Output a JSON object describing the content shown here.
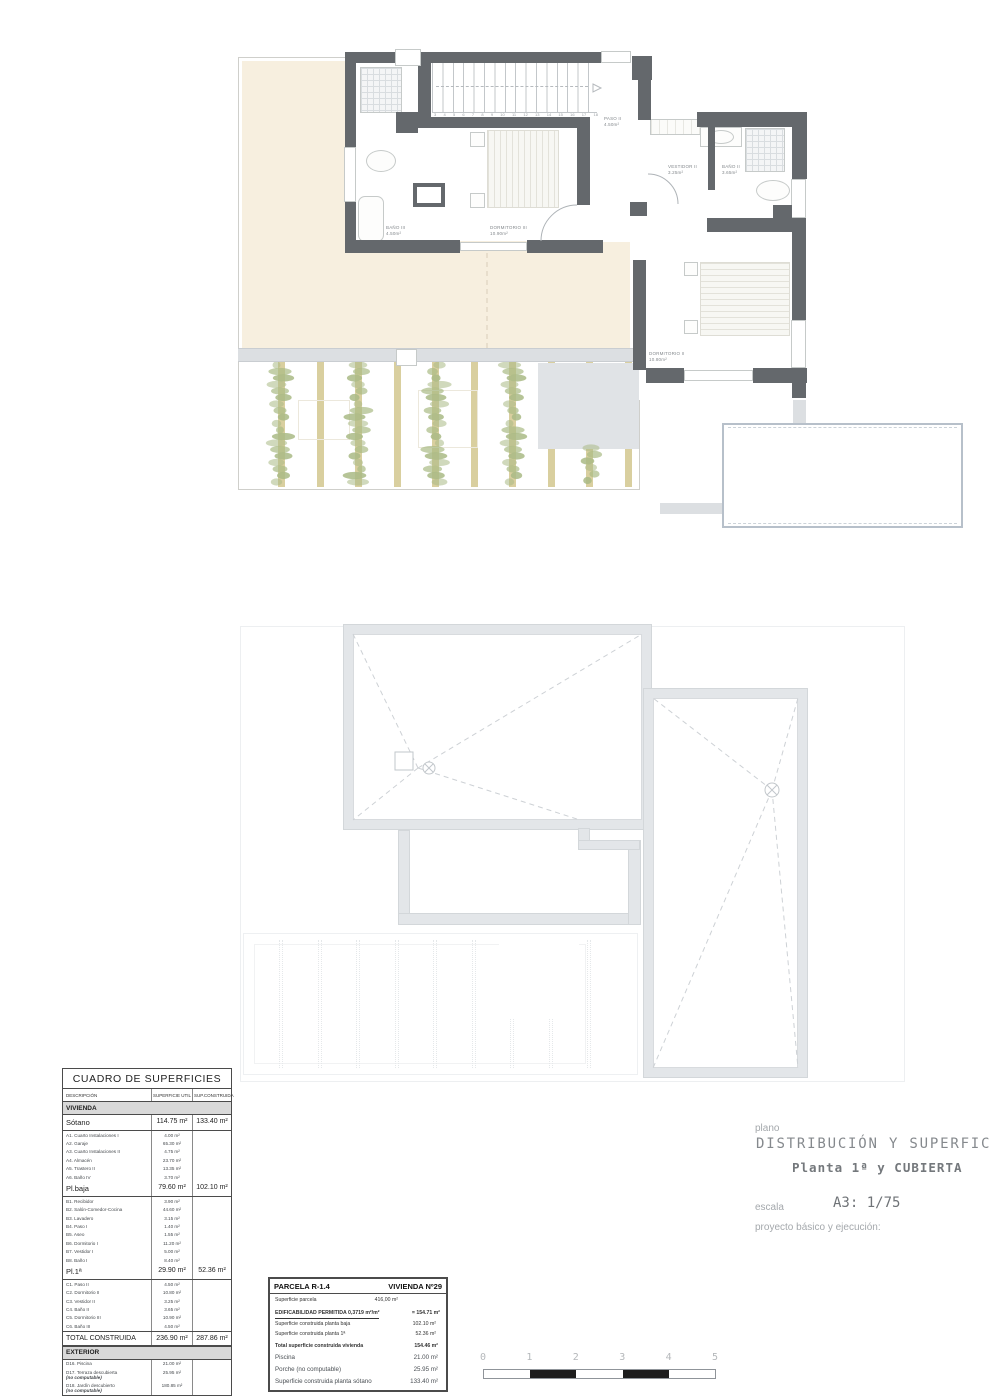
{
  "colors": {
    "wall": "#64686c",
    "terrace": "#f7efdf",
    "pergola_beam": "#d9cf9f",
    "plant": "#a9ba85",
    "roof_parapet": "#e3e6e9",
    "roof_dash": "#cdd1d5",
    "gray_band": "#dcdfe2",
    "pool_border": "#b7c0ca",
    "table_border": "#4b4b4b",
    "section_band_bg": "#d9d9d9",
    "title_gray": "#85898d",
    "muted_gray": "#a4a8ac",
    "scale_black": "#1d1d1d"
  },
  "floor_plan": {
    "rooms": [
      {
        "name": "BAÑO III",
        "area": "4.50m²"
      },
      {
        "name": "DORMITORIO III",
        "area": "10.90m²"
      },
      {
        "name": "PASO II",
        "area": "4.50m²"
      },
      {
        "name": "VESTIDOR II",
        "area": "3.25m²"
      },
      {
        "name": "BAÑO II",
        "area": "3.65m²"
      },
      {
        "name": "DORMITORIO II",
        "area": "10.80m²"
      }
    ],
    "stair_numbers": [
      "3",
      "4",
      "5",
      "6",
      "7",
      "8",
      "9",
      "10",
      "11",
      "12",
      "13",
      "14",
      "15",
      "16",
      "17",
      "18"
    ]
  },
  "surface_table": {
    "title": "CUADRO DE SUPERFICIES",
    "headers": [
      "DESCRIPCIÓN",
      "SUPERFICIE UTIL",
      "SUP.CONSTRUIDA"
    ],
    "rows": [
      {
        "type": "band",
        "label": "VIVIENDA"
      },
      {
        "type": "summary",
        "label": "Sótano",
        "util": "114.75 m²",
        "built": "133.40 m²"
      },
      {
        "type": "detail",
        "label": "A1. Cuarto Instalaciones I",
        "util": "4.00 m²"
      },
      {
        "type": "detail",
        "label": "A2. Garaje",
        "util": "65.30 m²"
      },
      {
        "type": "detail",
        "label": "A3. Cuarto Instalaciones II",
        "util": "4.75 m²"
      },
      {
        "type": "detail",
        "label": "A4. Almacén",
        "util": "23.70 m²"
      },
      {
        "type": "detail",
        "label": "A5. Trastero II",
        "util": "13.35 m²"
      },
      {
        "type": "detail",
        "label": "A6. Baño IV",
        "util": "3.70 m²"
      },
      {
        "type": "summary",
        "label": "Pl.baja",
        "util": "79.60 m²",
        "built": "102.10 m²"
      },
      {
        "type": "detail",
        "label": "B1. Recibidor",
        "util": "3.90 m²"
      },
      {
        "type": "detail",
        "label": "B2. Salón-Comedor-Cocina",
        "util": "44.60 m²"
      },
      {
        "type": "detail",
        "label": "B3. Lavadero",
        "util": "3.15 m²"
      },
      {
        "type": "detail",
        "label": "B4. Paso I",
        "util": "1.40 m²"
      },
      {
        "type": "detail",
        "label": "B5. Aseo",
        "util": "1.55 m²"
      },
      {
        "type": "detail",
        "label": "B6. Dormitorio I",
        "util": "11.20 m²"
      },
      {
        "type": "detail",
        "label": "B7. Vestidor I",
        "util": "5.00 m²"
      },
      {
        "type": "detail",
        "label": "B8. Baño I",
        "util": "8.40 m²"
      },
      {
        "type": "summary",
        "label": "Pl.1ª",
        "util": "29.90 m²",
        "built": "52.36 m²"
      },
      {
        "type": "detail",
        "label": "C1. Paso II",
        "util": "4.50 m²"
      },
      {
        "type": "detail",
        "label": "C2. Dormitorio II",
        "util": "10.80 m²"
      },
      {
        "type": "detail",
        "label": "C3. Vestidor II",
        "util": "3.25 m²"
      },
      {
        "type": "detail",
        "label": "C4. Baño II",
        "util": "3.65 m²"
      },
      {
        "type": "detail",
        "label": "C5. Dormitorio III",
        "util": "10.90 m²"
      },
      {
        "type": "detail",
        "label": "C6. Baño III",
        "util": "4.50 m²"
      },
      {
        "type": "total",
        "label": "TOTAL CONSTRUIDA",
        "util": "236.90 m²",
        "built": "287.86 m²"
      },
      {
        "type": "band",
        "label": "EXTERIOR"
      },
      {
        "type": "detail",
        "label": "D16. Piscina",
        "util": "21.00 m²"
      },
      {
        "type": "detail",
        "label": "D17. Terraza descubierta",
        "note": "(no computable)",
        "util": "25.95 m²"
      },
      {
        "type": "detail",
        "label": "D18. Jardín descubierto",
        "note": "(no computable)",
        "util": "180.85 m²"
      }
    ]
  },
  "parcela": {
    "title_left": "PARCELA R-1.4",
    "title_right": "VIVIENDA Nº29",
    "lines": [
      {
        "cls": "ln1",
        "label": "Superficie parcela",
        "value": "416,00 m²"
      },
      {
        "cls": "ln2",
        "label": "EDIFICABILIDAD PERMITIDA  0,3719 m²/m²",
        "value": "= 154.71 m²"
      },
      {
        "cls": "ln3",
        "label": "Superficie construida planta baja",
        "value": "102.10 m²"
      },
      {
        "cls": "ln3",
        "label": "Superficie construida planta 1ª",
        "value": "52.36 m²"
      },
      {
        "cls": "ln5",
        "label": "Total superficie construida vivienda",
        "value": "154.46 m²"
      },
      {
        "cls": "ln6",
        "label": "Piscina",
        "value": "21.00 m²"
      },
      {
        "cls": "ln6",
        "label": "Porche (no computable)",
        "value": "25.95 m²"
      },
      {
        "cls": "ln6",
        "label": "Superficie construida planta sótano",
        "value": "133.40 m²"
      }
    ]
  },
  "title_block": {
    "plano_label": "plano",
    "title": "DISTRIBUCIÓN Y SUPERFICIES",
    "subtitle": "Planta 1ª y CUBIERTA",
    "escala_label": "escala",
    "escala_value": "A3: 1/75",
    "project_label": "proyecto básico y ejecución:"
  },
  "scale_bar": {
    "numbers": [
      "0",
      "1",
      "2",
      "3",
      "4",
      "5"
    ]
  }
}
